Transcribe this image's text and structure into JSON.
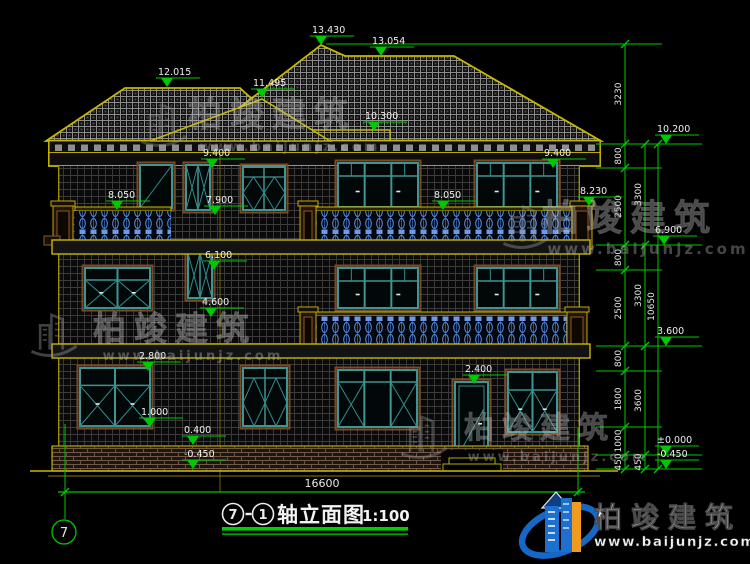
{
  "drawing": {
    "title": {
      "axis_start": "7",
      "axis_end": "1",
      "name": "轴立面图",
      "scale": "1:100"
    },
    "axis_bubble": "7",
    "bottom_dimension": "16600"
  },
  "elevation_markers": [
    {
      "value": "13.430",
      "x": 321,
      "y": 45
    },
    {
      "value": "13.054",
      "x": 381,
      "y": 56
    },
    {
      "value": "12.015",
      "x": 167,
      "y": 87
    },
    {
      "value": "11.495",
      "x": 262,
      "y": 98
    },
    {
      "value": "10.300",
      "x": 374,
      "y": 131
    },
    {
      "value": "9.400",
      "x": 212,
      "y": 168
    },
    {
      "value": "9.400",
      "x": 553,
      "y": 168
    },
    {
      "value": "8.050",
      "x": 117,
      "y": 210
    },
    {
      "value": "8.050",
      "x": 443,
      "y": 210
    },
    {
      "value": "8.230",
      "x": 589,
      "y": 206
    },
    {
      "value": "7.900",
      "x": 215,
      "y": 215
    },
    {
      "value": "6.900",
      "x": 664,
      "y": 245
    },
    {
      "value": "6.100",
      "x": 214,
      "y": 270
    },
    {
      "value": "4.600",
      "x": 211,
      "y": 317
    },
    {
      "value": "2.800",
      "x": 148,
      "y": 371
    },
    {
      "value": "2.400",
      "x": 474,
      "y": 384
    },
    {
      "value": "1.000",
      "x": 150,
      "y": 427
    },
    {
      "value": "0.400",
      "x": 193,
      "y": 445
    },
    {
      "value": "-0.450",
      "x": 193,
      "y": 469
    },
    {
      "value": "10.200",
      "x": 666,
      "y": 144
    },
    {
      "value": "3.600",
      "x": 666,
      "y": 346
    },
    {
      "value": "±0.000",
      "x": 666,
      "y": 455
    },
    {
      "value": "-0.450",
      "x": 666,
      "y": 469
    }
  ],
  "dimension_chains": [
    {
      "x": 625,
      "ticks": [
        44,
        144,
        168,
        245,
        270,
        346,
        371,
        427,
        455,
        469
      ],
      "labels": [
        "3230",
        "800",
        "2500",
        "800",
        "2500",
        "800",
        "1800",
        "1000",
        "450"
      ]
    },
    {
      "x": 645,
      "ticks": [
        144,
        245,
        346,
        455,
        469
      ],
      "labels": [
        "3300",
        "3300",
        "3600",
        "450"
      ]
    },
    {
      "x": 658,
      "ticks": [
        144,
        469
      ],
      "labels": [
        "10650"
      ]
    }
  ],
  "watermark": {
    "brand": "柏竣建筑",
    "url": "www.baijunjz.com",
    "instances": [
      {
        "x": 272,
        "y": 126,
        "size": 34,
        "url_y": 151,
        "url_size": 13,
        "lx": 138,
        "ly": 98,
        "op": 0.34
      },
      {
        "x": 630,
        "y": 230,
        "size": 36,
        "url_y": 254,
        "url_size": 15,
        "lx": 500,
        "ly": 200,
        "op": 0.4
      },
      {
        "x": 175,
        "y": 340,
        "size": 33,
        "url_y": 360,
        "url_size": 13,
        "lx": 28,
        "ly": 308,
        "op": 0.42
      },
      {
        "x": 540,
        "y": 438,
        "size": 30,
        "url_y": 461,
        "url_size": 13,
        "lx": 398,
        "ly": 410,
        "op": 0.38
      }
    ]
  },
  "logo": {
    "brand": "柏竣建筑",
    "url": "www.baijunjz.com"
  }
}
